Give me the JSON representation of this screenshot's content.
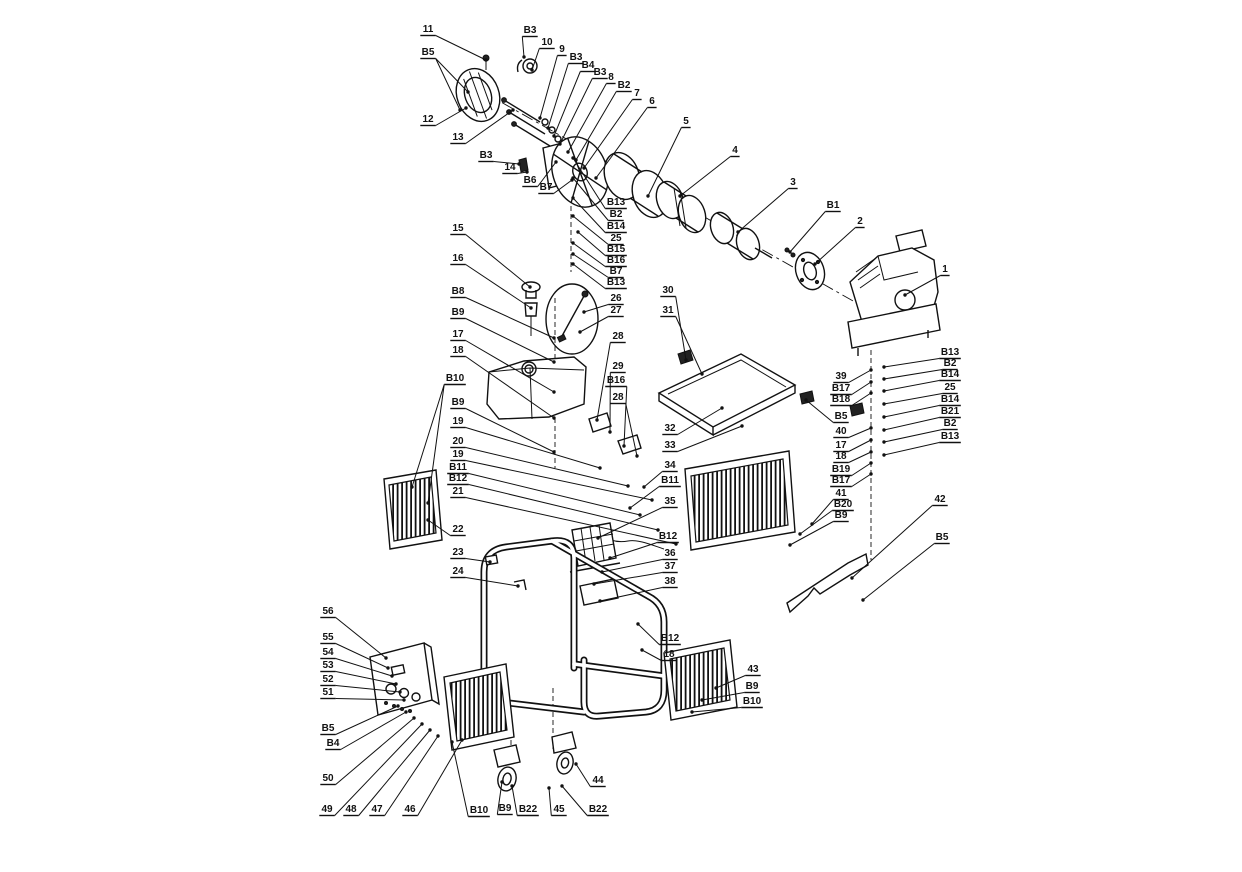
{
  "diagram": {
    "type": "exploded-parts-diagram",
    "background_color": "#ffffff",
    "line_color": "#111111",
    "callouts": [
      {
        "label": "11",
        "x": 428,
        "y": 32,
        "t": [
          [
            486,
            60
          ]
        ]
      },
      {
        "label": "B5",
        "x": 428,
        "y": 55,
        "t": [
          [
            468,
            92
          ],
          [
            460,
            110
          ]
        ]
      },
      {
        "label": "12",
        "x": 428,
        "y": 122,
        "t": [
          [
            466,
            108
          ]
        ]
      },
      {
        "label": "13",
        "x": 458,
        "y": 140,
        "t": [
          [
            513,
            110
          ]
        ]
      },
      {
        "label": "B3",
        "x": 530,
        "y": 33,
        "t": [
          [
            524,
            57
          ]
        ]
      },
      {
        "label": "10",
        "x": 547,
        "y": 45,
        "t": [
          [
            532,
            70
          ]
        ]
      },
      {
        "label": "9",
        "x": 562,
        "y": 52,
        "t": [
          [
            540,
            118
          ]
        ]
      },
      {
        "label": "B3",
        "x": 576,
        "y": 60,
        "t": [
          [
            548,
            128
          ]
        ]
      },
      {
        "label": "B4",
        "x": 588,
        "y": 68,
        "t": [
          [
            554,
            136
          ]
        ]
      },
      {
        "label": "B3",
        "x": 600,
        "y": 75,
        "t": [
          [
            560,
            144
          ]
        ]
      },
      {
        "label": "8",
        "x": 611,
        "y": 80,
        "t": [
          [
            568,
            152
          ]
        ]
      },
      {
        "label": "B2",
        "x": 624,
        "y": 88,
        "t": [
          [
            576,
            160
          ]
        ]
      },
      {
        "label": "7",
        "x": 637,
        "y": 96,
        "t": [
          [
            584,
            168
          ]
        ]
      },
      {
        "label": "6",
        "x": 652,
        "y": 104,
        "t": [
          [
            596,
            178
          ]
        ]
      },
      {
        "label": "5",
        "x": 686,
        "y": 124,
        "t": [
          [
            648,
            196
          ]
        ]
      },
      {
        "label": "4",
        "x": 735,
        "y": 153,
        "t": [
          [
            680,
            196
          ]
        ]
      },
      {
        "label": "3",
        "x": 793,
        "y": 185,
        "t": [
          [
            738,
            232
          ]
        ]
      },
      {
        "label": "B1",
        "x": 833,
        "y": 208,
        "t": [
          [
            790,
            252
          ]
        ]
      },
      {
        "label": "2",
        "x": 860,
        "y": 224,
        "t": [
          [
            815,
            264
          ]
        ]
      },
      {
        "label": "1",
        "x": 945,
        "y": 272,
        "t": [
          [
            905,
            295
          ]
        ]
      },
      {
        "label": "B3",
        "x": 486,
        "y": 158,
        "t": [
          [
            519,
            164
          ]
        ]
      },
      {
        "label": "14",
        "x": 510,
        "y": 170,
        "t": [
          [
            527,
            172
          ]
        ]
      },
      {
        "label": "B6",
        "x": 530,
        "y": 183,
        "t": [
          [
            556,
            162
          ]
        ]
      },
      {
        "label": "B7",
        "x": 546,
        "y": 190,
        "t": [
          [
            572,
            180
          ]
        ]
      },
      {
        "label": "B13",
        "x": 616,
        "y": 205,
        "t": [
          [
            573,
            158
          ]
        ]
      },
      {
        "label": "B2",
        "x": 616,
        "y": 217,
        "t": [
          [
            573,
            178
          ]
        ]
      },
      {
        "label": "B14",
        "x": 616,
        "y": 229,
        "t": [
          [
            573,
            198
          ]
        ]
      },
      {
        "label": "25",
        "x": 616,
        "y": 241,
        "t": [
          [
            573,
            216
          ]
        ]
      },
      {
        "label": "B15",
        "x": 616,
        "y": 252,
        "t": [
          [
            578,
            232
          ]
        ]
      },
      {
        "label": "B16",
        "x": 616,
        "y": 263,
        "t": [
          [
            573,
            243
          ]
        ]
      },
      {
        "label": "B7",
        "x": 616,
        "y": 274,
        "t": [
          [
            573,
            254
          ]
        ]
      },
      {
        "label": "B13",
        "x": 616,
        "y": 285,
        "t": [
          [
            573,
            264
          ]
        ]
      },
      {
        "label": "26",
        "x": 616,
        "y": 301,
        "t": [
          [
            584,
            312
          ]
        ]
      },
      {
        "label": "27",
        "x": 616,
        "y": 313,
        "t": [
          [
            580,
            332
          ]
        ]
      },
      {
        "label": "28",
        "x": 618,
        "y": 339,
        "t": [
          [
            597,
            420
          ]
        ]
      },
      {
        "label": "29",
        "x": 618,
        "y": 369,
        "t": [
          [
            610,
            432
          ]
        ]
      },
      {
        "label": "B16",
        "x": 616,
        "y": 383,
        "t": [
          [
            624,
            446
          ]
        ]
      },
      {
        "label": "28",
        "x": 618,
        "y": 400,
        "t": [
          [
            637,
            456
          ]
        ]
      },
      {
        "label": "15",
        "x": 458,
        "y": 231,
        "t": [
          [
            530,
            287
          ]
        ]
      },
      {
        "label": "16",
        "x": 458,
        "y": 261,
        "t": [
          [
            531,
            308
          ]
        ]
      },
      {
        "label": "B8",
        "x": 458,
        "y": 294,
        "t": [
          [
            554,
            338
          ]
        ]
      },
      {
        "label": "B9",
        "x": 458,
        "y": 315,
        "t": [
          [
            554,
            362
          ]
        ]
      },
      {
        "label": "17",
        "x": 458,
        "y": 337,
        "t": [
          [
            554,
            392
          ]
        ]
      },
      {
        "label": "18",
        "x": 458,
        "y": 353,
        "t": [
          [
            554,
            418
          ]
        ]
      },
      {
        "label": "B10",
        "x": 455,
        "y": 381,
        "t": [
          [
            412,
            487
          ],
          [
            428,
            503
          ]
        ]
      },
      {
        "label": "B9",
        "x": 458,
        "y": 405,
        "t": [
          [
            554,
            452
          ]
        ]
      },
      {
        "label": "19",
        "x": 458,
        "y": 424,
        "t": [
          [
            600,
            468
          ]
        ]
      },
      {
        "label": "20",
        "x": 458,
        "y": 444,
        "t": [
          [
            628,
            486
          ]
        ]
      },
      {
        "label": "19",
        "x": 458,
        "y": 457,
        "t": [
          [
            652,
            500
          ]
        ]
      },
      {
        "label": "B11",
        "x": 458,
        "y": 470,
        "t": [
          [
            640,
            515
          ]
        ]
      },
      {
        "label": "B12",
        "x": 458,
        "y": 481,
        "t": [
          [
            658,
            530
          ]
        ]
      },
      {
        "label": "21",
        "x": 458,
        "y": 494,
        "t": [
          [
            676,
            544
          ]
        ]
      },
      {
        "label": "22",
        "x": 458,
        "y": 532,
        "t": [
          [
            428,
            520
          ]
        ]
      },
      {
        "label": "23",
        "x": 458,
        "y": 555,
        "t": [
          [
            490,
            562
          ]
        ]
      },
      {
        "label": "24",
        "x": 458,
        "y": 574,
        "t": [
          [
            518,
            586
          ]
        ]
      },
      {
        "label": "30",
        "x": 668,
        "y": 293,
        "t": [
          [
            686,
            360
          ]
        ]
      },
      {
        "label": "31",
        "x": 668,
        "y": 313,
        "t": [
          [
            702,
            374
          ]
        ]
      },
      {
        "label": "32",
        "x": 670,
        "y": 431,
        "t": [
          [
            722,
            408
          ]
        ]
      },
      {
        "label": "33",
        "x": 670,
        "y": 448,
        "t": [
          [
            742,
            426
          ]
        ]
      },
      {
        "label": "34",
        "x": 670,
        "y": 468,
        "t": [
          [
            644,
            487
          ]
        ]
      },
      {
        "label": "B11",
        "x": 670,
        "y": 483,
        "t": [
          [
            630,
            508
          ]
        ]
      },
      {
        "label": "35",
        "x": 670,
        "y": 504,
        "t": [
          [
            598,
            538
          ]
        ]
      },
      {
        "label": "B12",
        "x": 668,
        "y": 539,
        "t": [
          [
            610,
            558
          ]
        ]
      },
      {
        "label": "36",
        "x": 670,
        "y": 556,
        "t": [
          [
            602,
            572
          ]
        ]
      },
      {
        "label": "37",
        "x": 670,
        "y": 569,
        "t": [
          [
            594,
            584
          ]
        ]
      },
      {
        "label": "38",
        "x": 670,
        "y": 584,
        "t": [
          [
            600,
            601
          ]
        ]
      },
      {
        "label": "B12",
        "x": 670,
        "y": 641,
        "t": [
          [
            638,
            624
          ]
        ]
      },
      {
        "label": "18",
        "x": 669,
        "y": 657,
        "t": [
          [
            642,
            650
          ]
        ]
      },
      {
        "label": "43",
        "x": 753,
        "y": 672,
        "t": [
          [
            716,
            688
          ]
        ]
      },
      {
        "label": "B9",
        "x": 752,
        "y": 689,
        "t": [
          [
            702,
            700
          ]
        ]
      },
      {
        "label": "B10",
        "x": 752,
        "y": 704,
        "t": [
          [
            692,
            712
          ]
        ]
      },
      {
        "label": "39",
        "x": 841,
        "y": 379,
        "t": [
          [
            871,
            370
          ]
        ]
      },
      {
        "label": "B17",
        "x": 841,
        "y": 391,
        "t": [
          [
            871,
            382
          ]
        ]
      },
      {
        "label": "B18",
        "x": 841,
        "y": 402,
        "t": [
          [
            871,
            393
          ]
        ]
      },
      {
        "label": "B5",
        "x": 841,
        "y": 419,
        "t": [
          [
            806,
            400
          ]
        ]
      },
      {
        "label": "40",
        "x": 841,
        "y": 434,
        "t": [
          [
            871,
            428
          ]
        ]
      },
      {
        "label": "17",
        "x": 841,
        "y": 448,
        "t": [
          [
            871,
            440
          ]
        ]
      },
      {
        "label": "18",
        "x": 841,
        "y": 459,
        "t": [
          [
            871,
            452
          ]
        ]
      },
      {
        "label": "B19",
        "x": 841,
        "y": 472,
        "t": [
          [
            871,
            463
          ]
        ]
      },
      {
        "label": "B17",
        "x": 841,
        "y": 483,
        "t": [
          [
            871,
            474
          ]
        ]
      },
      {
        "label": "41",
        "x": 841,
        "y": 496,
        "t": [
          [
            812,
            524
          ]
        ]
      },
      {
        "label": "B20",
        "x": 843,
        "y": 507,
        "t": [
          [
            800,
            534
          ]
        ]
      },
      {
        "label": "B9",
        "x": 841,
        "y": 518,
        "t": [
          [
            790,
            545
          ]
        ]
      },
      {
        "label": "B13",
        "x": 950,
        "y": 355,
        "t": [
          [
            884,
            367
          ]
        ]
      },
      {
        "label": "B2",
        "x": 950,
        "y": 366,
        "t": [
          [
            884,
            379
          ]
        ]
      },
      {
        "label": "B14",
        "x": 950,
        "y": 377,
        "t": [
          [
            884,
            391
          ]
        ]
      },
      {
        "label": "25",
        "x": 950,
        "y": 390,
        "t": [
          [
            884,
            404
          ]
        ]
      },
      {
        "label": "B14",
        "x": 950,
        "y": 402,
        "t": [
          [
            884,
            417
          ]
        ]
      },
      {
        "label": "B21",
        "x": 950,
        "y": 414,
        "t": [
          [
            884,
            430
          ]
        ]
      },
      {
        "label": "B2",
        "x": 950,
        "y": 426,
        "t": [
          [
            884,
            442
          ]
        ]
      },
      {
        "label": "B13",
        "x": 950,
        "y": 439,
        "t": [
          [
            884,
            455
          ]
        ]
      },
      {
        "label": "42",
        "x": 940,
        "y": 502,
        "t": [
          [
            852,
            578
          ]
        ]
      },
      {
        "label": "B5",
        "x": 942,
        "y": 540,
        "t": [
          [
            863,
            600
          ]
        ]
      },
      {
        "label": "56",
        "x": 328,
        "y": 614,
        "t": [
          [
            386,
            658
          ]
        ]
      },
      {
        "label": "55",
        "x": 328,
        "y": 640,
        "t": [
          [
            388,
            668
          ]
        ]
      },
      {
        "label": "54",
        "x": 328,
        "y": 655,
        "t": [
          [
            392,
            676
          ]
        ]
      },
      {
        "label": "53",
        "x": 328,
        "y": 668,
        "t": [
          [
            396,
            684
          ]
        ]
      },
      {
        "label": "52",
        "x": 328,
        "y": 682,
        "t": [
          [
            400,
            692
          ]
        ]
      },
      {
        "label": "51",
        "x": 328,
        "y": 695,
        "t": [
          [
            404,
            700
          ]
        ]
      },
      {
        "label": "B5",
        "x": 328,
        "y": 731,
        "t": [
          [
            398,
            706
          ]
        ]
      },
      {
        "label": "B4",
        "x": 333,
        "y": 746,
        "t": [
          [
            406,
            712
          ]
        ]
      },
      {
        "label": "50",
        "x": 328,
        "y": 781,
        "t": [
          [
            414,
            718
          ]
        ]
      },
      {
        "label": "49",
        "x": 327,
        "y": 812,
        "t": [
          [
            422,
            724
          ]
        ]
      },
      {
        "label": "48",
        "x": 351,
        "y": 812,
        "t": [
          [
            430,
            730
          ]
        ]
      },
      {
        "label": "47",
        "x": 377,
        "y": 812,
        "t": [
          [
            438,
            736
          ]
        ]
      },
      {
        "label": "46",
        "x": 410,
        "y": 812,
        "t": [
          [
            462,
            740
          ]
        ]
      },
      {
        "label": "B10",
        "x": 479,
        "y": 813,
        "t": [
          [
            452,
            742
          ]
        ]
      },
      {
        "label": "B9",
        "x": 505,
        "y": 811,
        "t": [
          [
            502,
            782
          ]
        ]
      },
      {
        "label": "B22",
        "x": 528,
        "y": 812,
        "t": [
          [
            512,
            786
          ]
        ]
      },
      {
        "label": "45",
        "x": 559,
        "y": 812,
        "t": [
          [
            549,
            788
          ]
        ]
      },
      {
        "label": "B22",
        "x": 598,
        "y": 812,
        "t": [
          [
            562,
            786
          ]
        ]
      },
      {
        "label": "44",
        "x": 598,
        "y": 783,
        "t": [
          [
            576,
            764
          ]
        ]
      }
    ]
  }
}
